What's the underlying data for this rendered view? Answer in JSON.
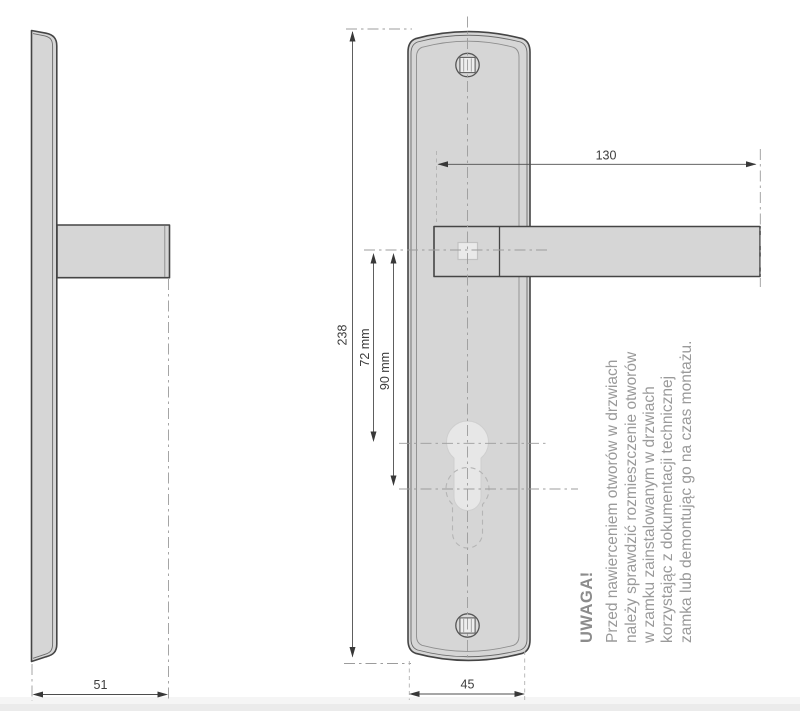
{
  "drawing": {
    "dims": {
      "side_width": "51",
      "plate_width": "45",
      "plate_height": "238",
      "handle_length": "130",
      "handle_to_cylinder_72": "72 mm",
      "handle_to_cylinder_90": "90 mm"
    },
    "note": {
      "heading": "UWAGA!",
      "lines": [
        "Przed nawierceniem otworów w drzwiach",
        "należy sprawdzić rozmieszczenie otworów",
        "w zamku zainstalowanym w drzwiach",
        "korzystając z dokumentacji technicznej",
        "zamka lub demontując go na czas montażu."
      ]
    },
    "colors": {
      "plate_fill": "#d6d6d6",
      "outline": "#454545",
      "dimension_line": "#4d4d4d",
      "centerline": "#9c9c9c",
      "note_text": "#9a9a9a"
    }
  }
}
